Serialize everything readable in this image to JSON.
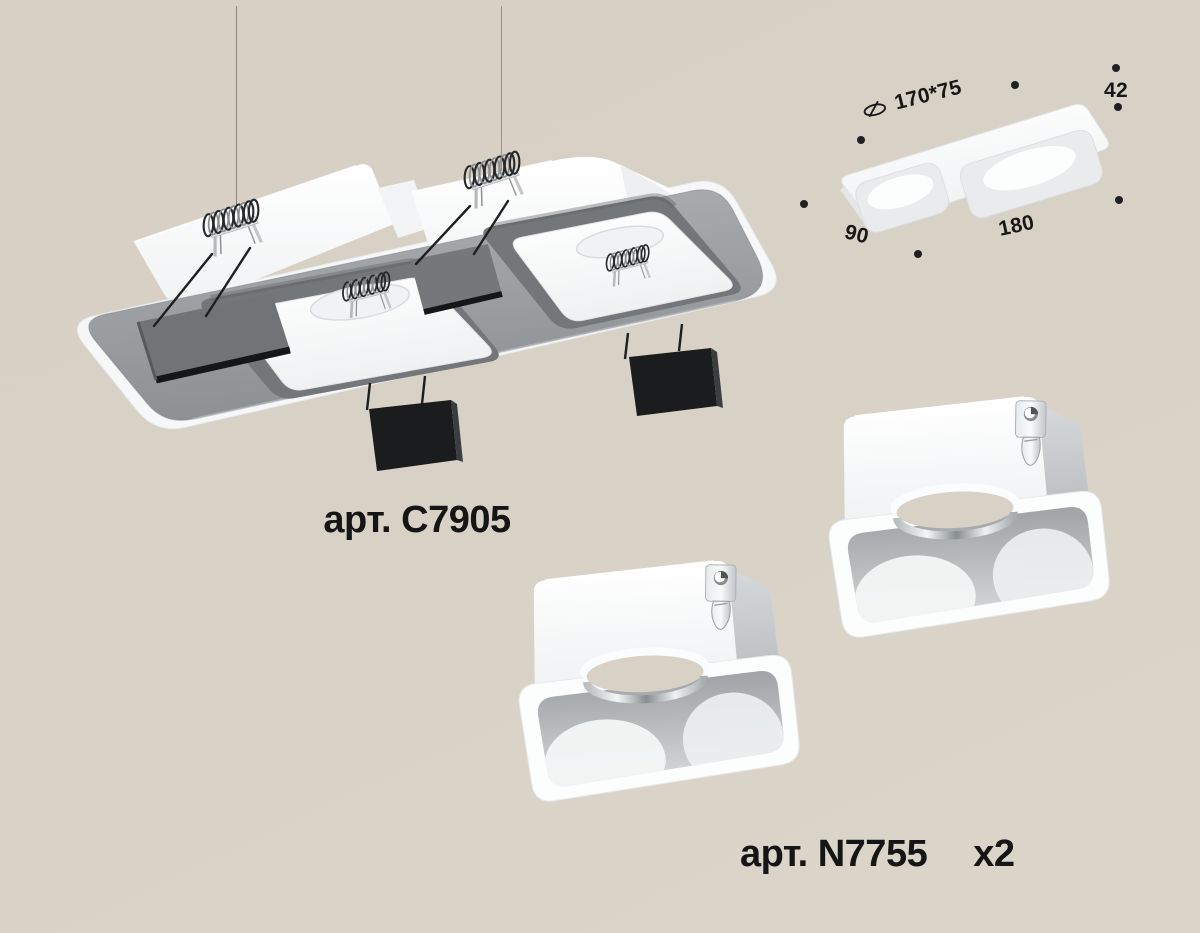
{
  "canvas": {
    "width": 1200,
    "height": 933,
    "background": "#d8d1c5"
  },
  "colors": {
    "text": "#171717",
    "flange_gray": "#96999c",
    "housing_white": "#f8f9fa",
    "anchor_black": "#1a1c1e",
    "chrome": "#c9cdd0",
    "marker_dot": "#1f2022"
  },
  "products": {
    "frame": {
      "article": "арт. C7905"
    },
    "insert": {
      "article": "арт. N7755",
      "count": "x2"
    }
  },
  "dimensions": {
    "cutout": "170*75",
    "height": "42",
    "width": "90",
    "length": "180"
  },
  "icons": {
    "cutout_icon": "slashed-ellipse"
  }
}
